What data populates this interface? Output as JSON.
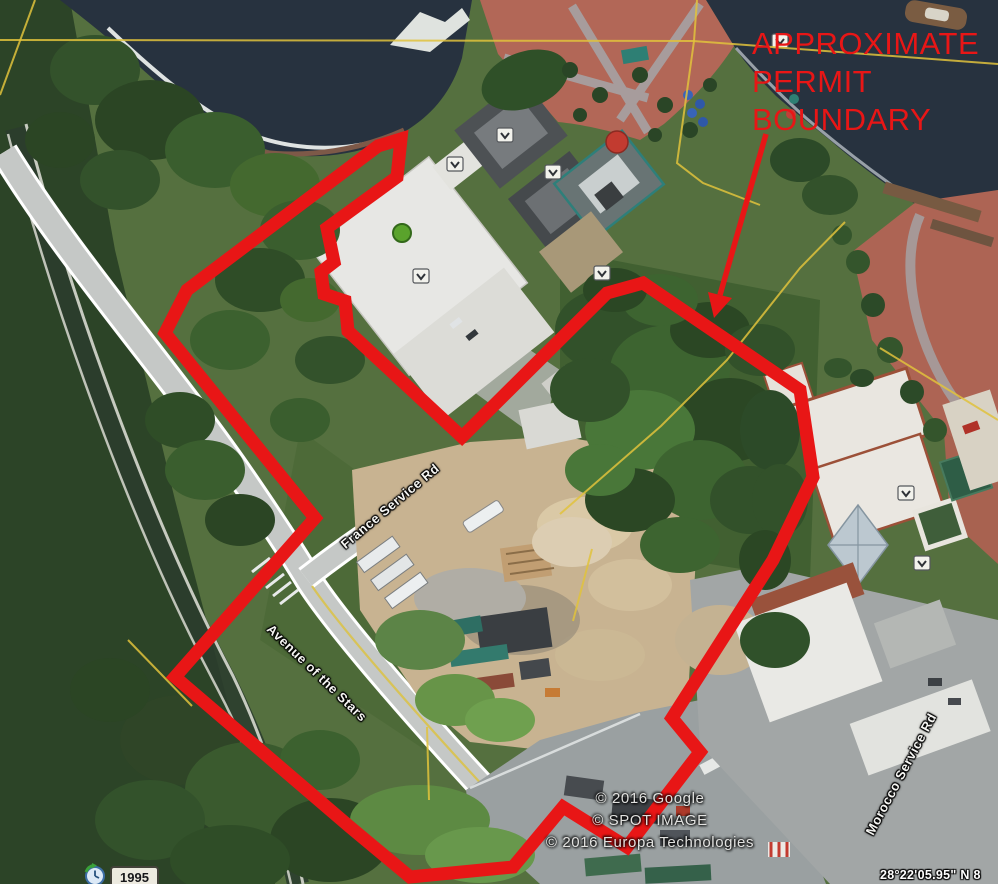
{
  "annotation": {
    "color": "#e81616",
    "label": {
      "text_lines": [
        "APPROXIMATE",
        "PERMIT",
        "BOUNDARY"
      ]
    },
    "boundary_stroke_width": 13,
    "boundary_points": [
      [
        378,
        146
      ],
      [
        401,
        139
      ],
      [
        397,
        177
      ],
      [
        327,
        228
      ],
      [
        334,
        262
      ],
      [
        321,
        272
      ],
      [
        324,
        294
      ],
      [
        345,
        301
      ],
      [
        348,
        331
      ],
      [
        462,
        437
      ],
      [
        607,
        293
      ],
      [
        643,
        283
      ],
      [
        800,
        390
      ],
      [
        813,
        477
      ],
      [
        773,
        560
      ],
      [
        672,
        718
      ],
      [
        700,
        752
      ],
      [
        627,
        847
      ],
      [
        563,
        807
      ],
      [
        513,
        867
      ],
      [
        410,
        877
      ],
      [
        350,
        827
      ],
      [
        175,
        677
      ],
      [
        315,
        518
      ],
      [
        165,
        333
      ],
      [
        187,
        290
      ]
    ],
    "arrow": {
      "line": [
        [
          766,
          134
        ],
        [
          720,
          295
        ]
      ],
      "head": [
        [
          714,
          318
        ],
        [
          708,
          292
        ],
        [
          732,
          298
        ]
      ]
    }
  },
  "road_labels": [
    {
      "text": "France Service Rd",
      "x": 390,
      "y": 506,
      "angle": -40
    },
    {
      "text": "Avenue of the Stars",
      "x": 317,
      "y": 673,
      "angle": 44
    },
    {
      "text": "Morocco Service Rd",
      "x": 901,
      "y": 774,
      "angle": -62
    }
  ],
  "kml_overlay": {
    "color": "#e0c23c",
    "lines": [
      [
        [
          0,
          40
        ],
        [
          693,
          41
        ],
        [
          998,
          64
        ]
      ],
      [
        [
          35,
          0
        ],
        [
          0,
          95
        ]
      ],
      [
        [
          697,
          0
        ],
        [
          694,
          41
        ],
        [
          677,
          163
        ],
        [
          703,
          183
        ],
        [
          760,
          205
        ]
      ],
      [
        [
          845,
          222
        ],
        [
          800,
          268
        ],
        [
          727,
          360
        ],
        [
          661,
          426
        ],
        [
          560,
          514
        ]
      ],
      [
        [
          880,
          348
        ],
        [
          998,
          420
        ]
      ],
      [
        [
          592,
          549
        ],
        [
          573,
          621
        ]
      ],
      [
        [
          427,
          727
        ],
        [
          429,
          800
        ]
      ],
      [
        [
          128,
          640
        ],
        [
          192,
          706
        ]
      ]
    ]
  },
  "attribution": [
    "© 2016 Google",
    "© SPOT IMAGE",
    "© 2016 Europa Technologies"
  ],
  "status_bar": {
    "coordinates": "28°22'05.95\" N   8",
    "imagery_year": "1995"
  }
}
